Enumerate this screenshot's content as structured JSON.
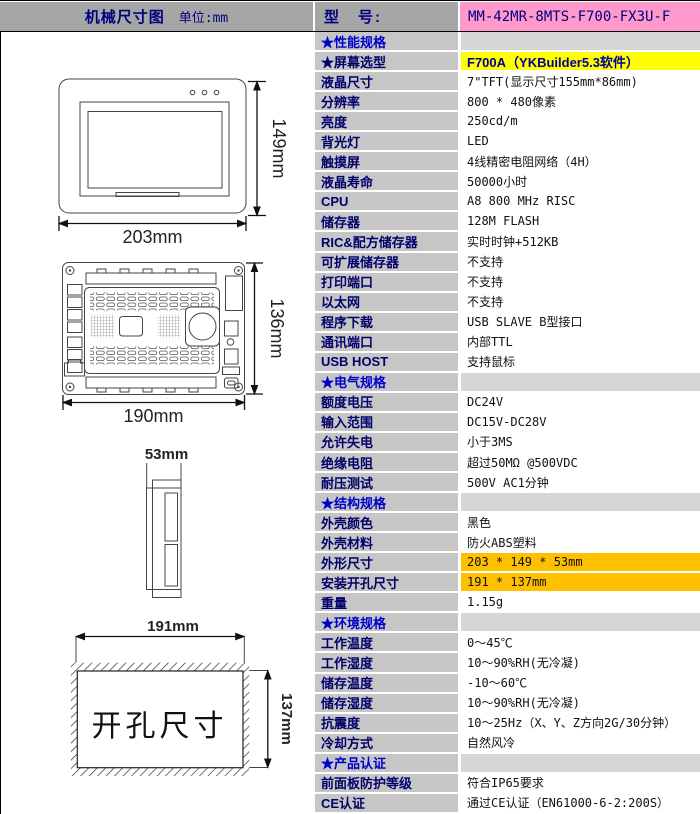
{
  "header": {
    "left_title": "机械尺寸图",
    "left_unit": "单位:mm",
    "model_label": "型　号:",
    "model_value": "MM-42MR-8MTS-F700-FX3U-F"
  },
  "drawings": {
    "front": {
      "width_label": "203mm",
      "height_label": "149mm"
    },
    "back": {
      "width_label": "190mm",
      "height_label": "136mm"
    },
    "side": {
      "depth_label": "53mm"
    },
    "cutout": {
      "width_label": "191mm",
      "height_label": "137mm",
      "caption": "开孔尺寸"
    }
  },
  "colors": {
    "header_gray": "#a6a6a6",
    "label_gray": "#c6c6c6",
    "section_value_gray": "#d6d6d6",
    "pink": "#ff99cc",
    "yellow": "#ffff00",
    "orange": "#ffc000",
    "label_navy": "#00006b",
    "section_blue": "#0000cc"
  },
  "spec_table": {
    "rows": [
      {
        "label": "★性能规格",
        "value": "",
        "type": "section"
      },
      {
        "label": "★屏幕选型",
        "value": "F700A（YKBuilder5.3软件）",
        "type": "yellow"
      },
      {
        "label": "液晶尺寸",
        "value": "7\"TFT(显示尺寸155mm*86mm)",
        "type": "normal"
      },
      {
        "label": "分辨率",
        "value": "800 * 480像素",
        "type": "normal"
      },
      {
        "label": "亮度",
        "value": "250cd/m",
        "type": "normal"
      },
      {
        "label": "背光灯",
        "value": "LED",
        "type": "normal"
      },
      {
        "label": "触摸屏",
        "value": "4线精密电阻网络（4H）",
        "type": "normal"
      },
      {
        "label": "液晶寿命",
        "value": "50000小时",
        "type": "normal"
      },
      {
        "label": "CPU",
        "value": "A8 800 MHz RISC",
        "type": "normal"
      },
      {
        "label": "储存器",
        "value": "128M FLASH",
        "type": "normal"
      },
      {
        "label": "RIC&配方储存器",
        "value": "实时时钟+512KB",
        "type": "normal"
      },
      {
        "label": "可扩展储存器",
        "value": "不支持",
        "type": "normal"
      },
      {
        "label": "打印端口",
        "value": "不支持",
        "type": "normal"
      },
      {
        "label": "以太网",
        "value": "不支持",
        "type": "normal"
      },
      {
        "label": "程序下载",
        "value": "USB SLAVE B型接口",
        "type": "normal"
      },
      {
        "label": "通讯端口",
        "value": "内部TTL",
        "type": "normal"
      },
      {
        "label": "USB HOST",
        "value": "支持鼠标",
        "type": "normal"
      },
      {
        "label": "★电气规格",
        "value": "",
        "type": "section"
      },
      {
        "label": "额度电压",
        "value": "DC24V",
        "type": "normal"
      },
      {
        "label": "输入范围",
        "value": "DC15V-DC28V",
        "type": "normal"
      },
      {
        "label": "允许失电",
        "value": "小于3MS",
        "type": "normal"
      },
      {
        "label": "绝缘电阻",
        "value": "超过50MΩ @500VDC",
        "type": "normal"
      },
      {
        "label": "耐压测试",
        "value": "500V AC1分钟",
        "type": "normal"
      },
      {
        "label": "★结构规格",
        "value": "",
        "type": "section"
      },
      {
        "label": "外壳颜色",
        "value": "黑色",
        "type": "normal"
      },
      {
        "label": "外壳材料",
        "value": "防火ABS塑料",
        "type": "normal"
      },
      {
        "label": "外形尺寸",
        "value": "203 * 149 * 53mm",
        "type": "orange"
      },
      {
        "label": "安装开孔尺寸",
        "value": "191 * 137mm",
        "type": "orange"
      },
      {
        "label": "重量",
        "value": "1.15g",
        "type": "normal"
      },
      {
        "label": "★环境规格",
        "value": "",
        "type": "section"
      },
      {
        "label": "工作温度",
        "value": "0～45℃",
        "type": "normal"
      },
      {
        "label": "工作湿度",
        "value": "10～90%RH(无冷凝)",
        "type": "normal"
      },
      {
        "label": "储存温度",
        "value": "-10～60℃",
        "type": "normal"
      },
      {
        "label": "储存湿度",
        "value": "10～90%RH(无冷凝)",
        "type": "normal"
      },
      {
        "label": "抗震度",
        "value": "10～25Hz（X、Y、Z方向2G/30分钟）",
        "type": "normal"
      },
      {
        "label": "冷却方式",
        "value": "自然风冷",
        "type": "normal"
      },
      {
        "label": "★产品认证",
        "value": "",
        "type": "section"
      },
      {
        "label": "前面板防护等级",
        "value": "符合IP65要求",
        "type": "normal"
      },
      {
        "label": "CE认证",
        "value": "通过CE认证（EN61000-6-2:200S）",
        "type": "normal"
      }
    ]
  }
}
